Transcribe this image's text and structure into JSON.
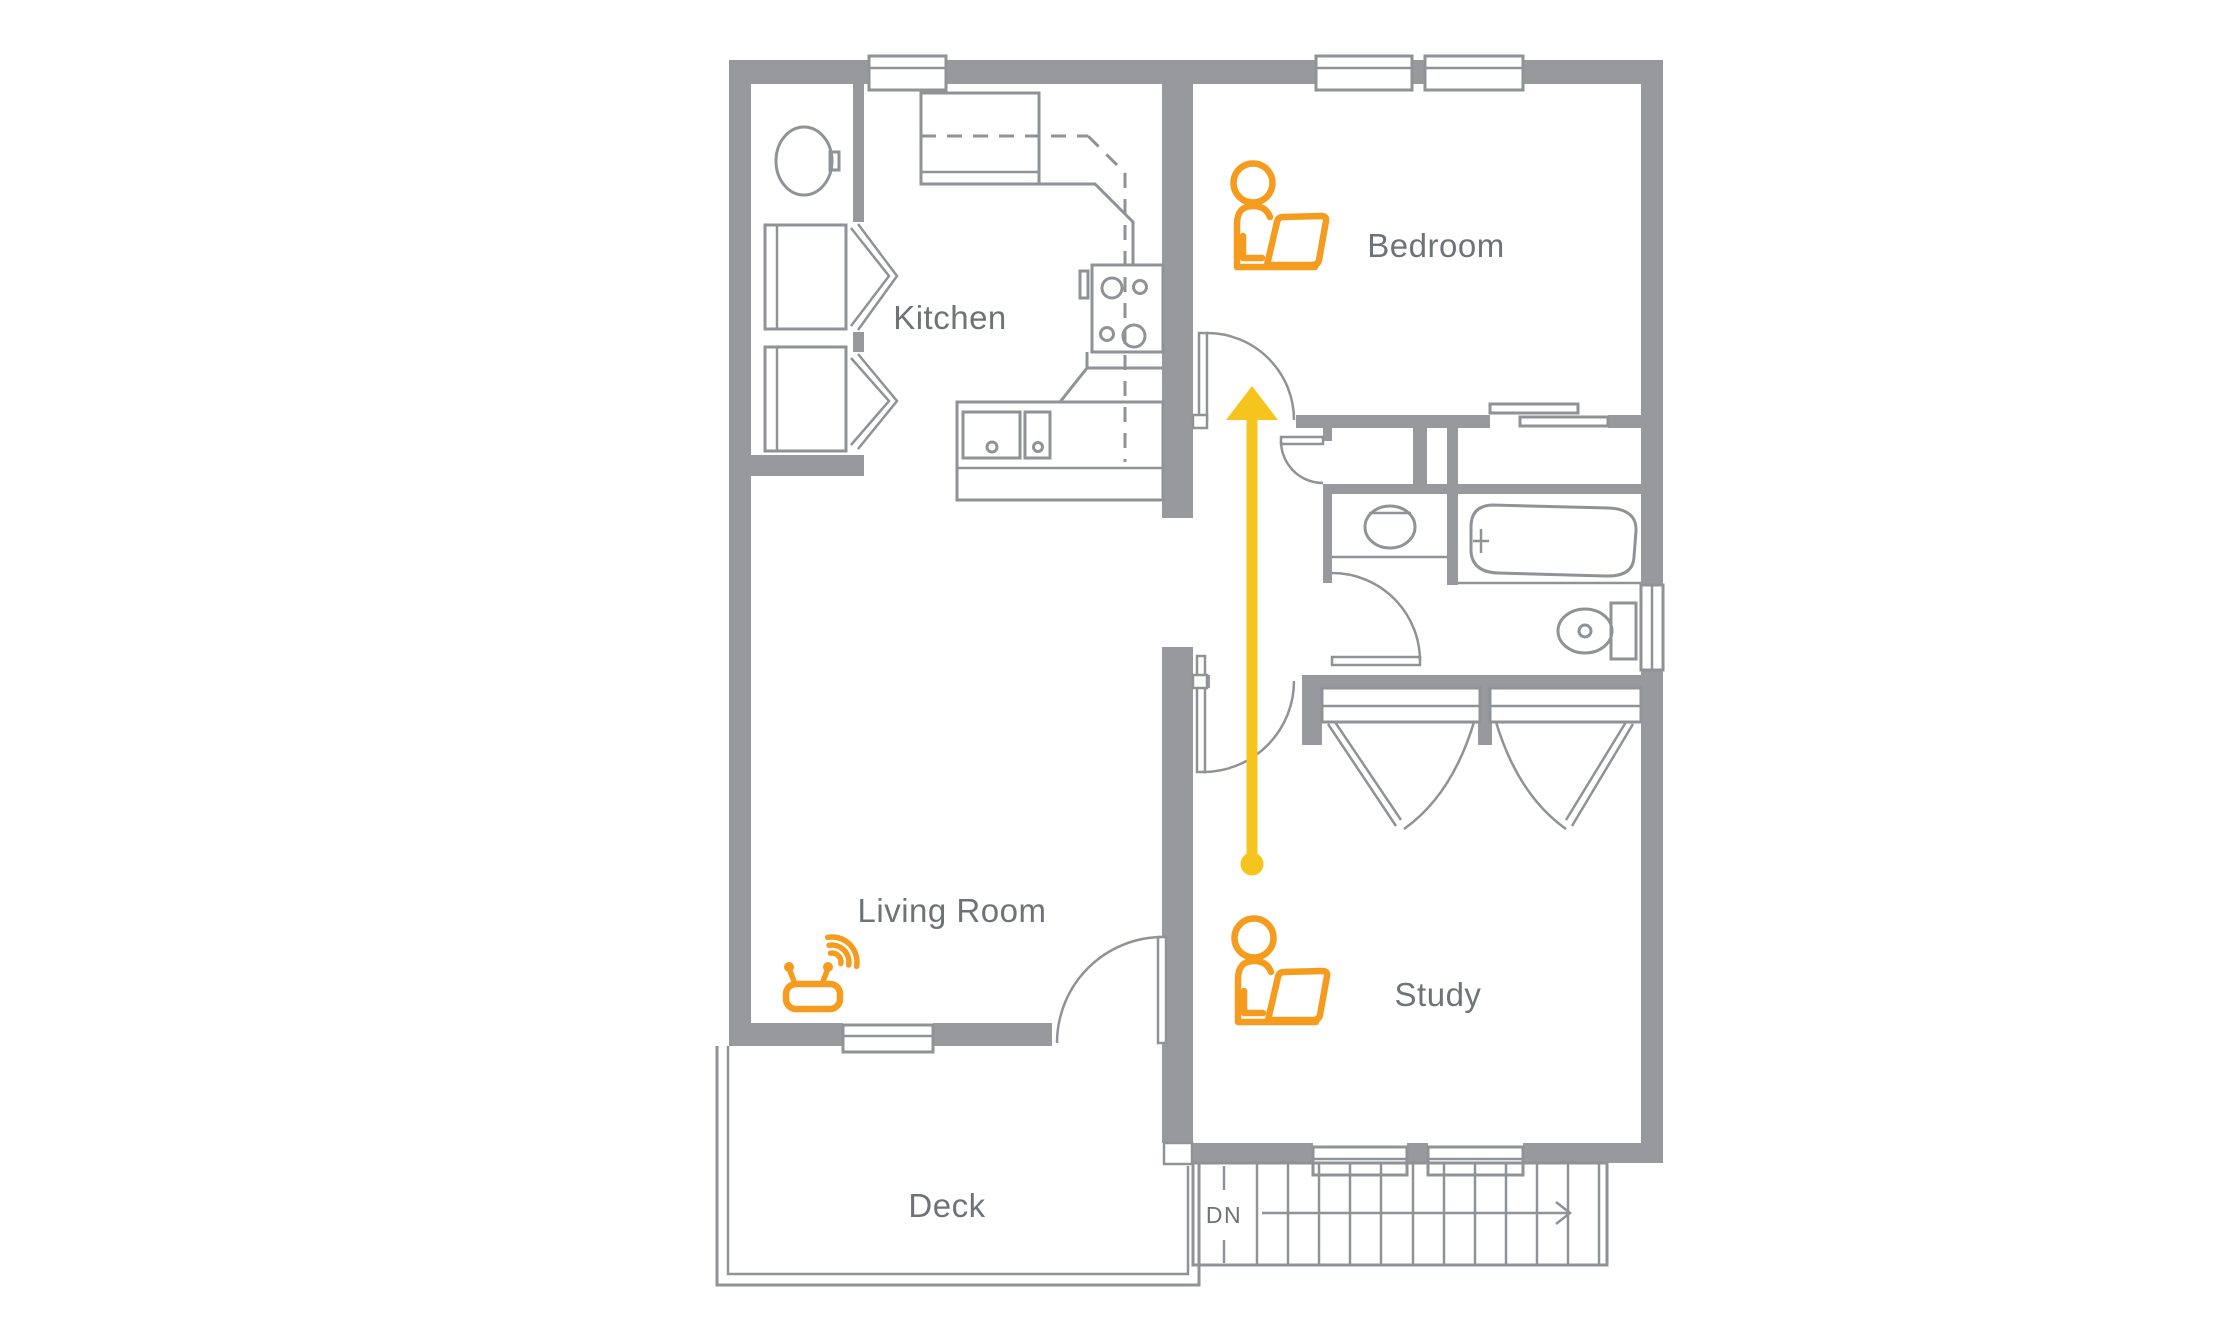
{
  "rooms": {
    "kitchen": "Kitchen",
    "bedroom": "Bedroom",
    "living_room": "Living Room",
    "study": "Study",
    "deck": "Deck"
  },
  "stairs": {
    "down_label": "DN"
  },
  "icons": {
    "bedroom_occupant": "person-with-laptop-icon",
    "study_occupant": "person-with-laptop-icon",
    "living_room_router": "wifi-router-icon",
    "signal_arrow": "signal-path-arrow",
    "stairs_direction": "stairs-down-arrow"
  },
  "fixtures": [
    "washer",
    "dryer",
    "laundry-basin",
    "refrigerator",
    "upper-cabinets",
    "stove",
    "kitchen-sink",
    "dishwasher",
    "bathroom-sink",
    "bathtub",
    "toilet",
    "closet-bifold-doors",
    "sliding-closet-doors"
  ],
  "colors": {
    "wall": "#97999D",
    "line": "#8F9296",
    "text": "#6E7377",
    "orange": "#F59B1E",
    "yellow": "#F5C51D"
  }
}
